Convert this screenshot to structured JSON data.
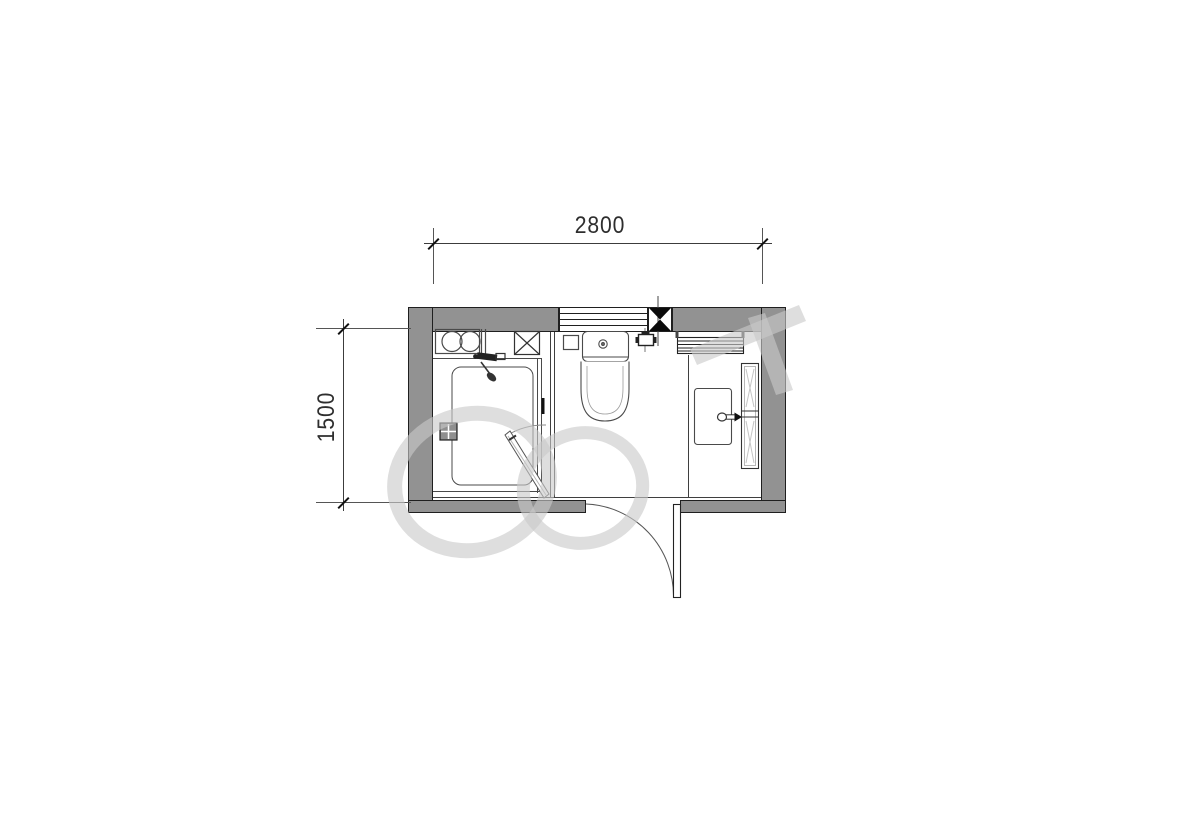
{
  "drawing": {
    "kind": "bathroom-floor-plan",
    "dimensions": {
      "width_mm": "2800",
      "height_mm": "1500"
    }
  },
  "fixtures": {
    "counter_basins": "double-round-basin-counter",
    "duct_box": "x-marked-shaft",
    "shower": "shower-enclosure-with-tray",
    "shower_mixer": "shower-mixer-set",
    "shower_door": "pivot-glass-door",
    "floor_drain": "floor-drain-grid",
    "toilet": "toilet-with-cistern",
    "wall_box": "wall-access-box",
    "inlet_valve": "water-inlet-valve",
    "window": "four-pane-window",
    "pipe_column": "black-bowtie-column",
    "towel_radiator": "towel-radiator",
    "vanity_basin": "rectangular-basin",
    "faucet": "basin-faucet",
    "side_cabinet": "tall-side-cabinet",
    "entry_door": "outward-swing-door"
  },
  "colors": {
    "wall_fill": "#929292",
    "line": "#3c3c3c",
    "column_fill": "#0a0a0a",
    "watermark": "#c9c9c9",
    "background": "#ffffff"
  }
}
